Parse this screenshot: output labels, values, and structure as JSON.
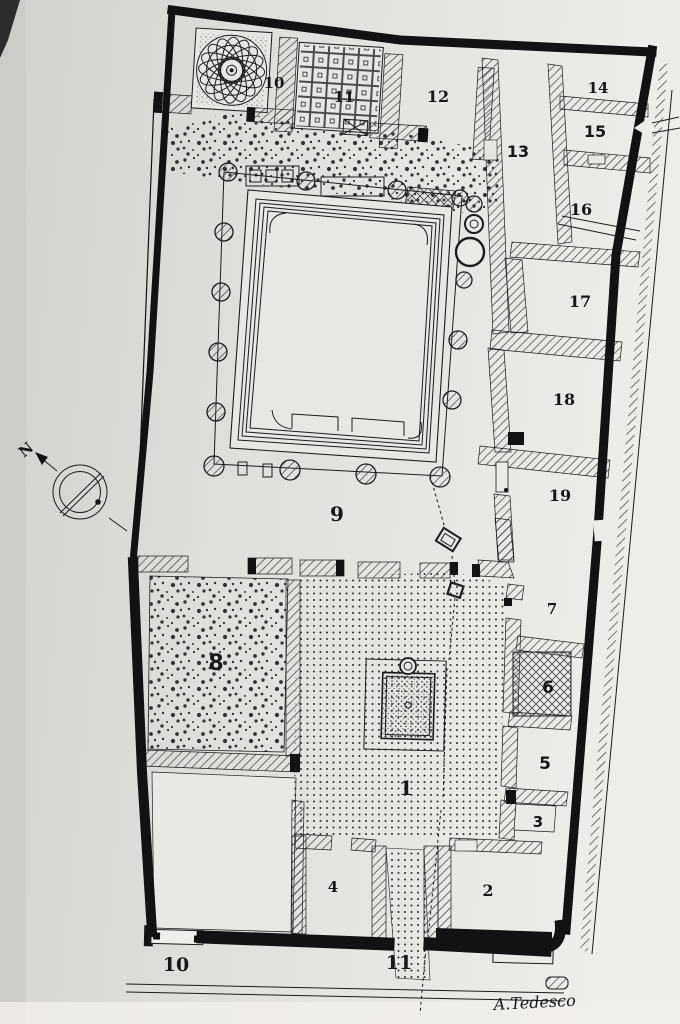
{
  "plan": {
    "rooms": {
      "r1": "1",
      "r2": "2",
      "r3": "3",
      "r4": "4",
      "r5": "5",
      "r6": "6",
      "r7": "7",
      "r8": "8",
      "r9": "9",
      "r10_top": "10",
      "r11_top": "11",
      "r12": "12",
      "r13": "13",
      "r14": "14",
      "r15": "15",
      "r16": "16",
      "r17": "17",
      "r18": "18",
      "r19": "19",
      "r10_entrance": "10",
      "r11_entrance": "11"
    },
    "compass_north": "N",
    "signature": "A.Tedesco",
    "colors": {
      "paper": "#dcdad6",
      "paper_light": "#eeece8",
      "ink": "#1c1c1c",
      "wall_black": "#121212"
    }
  }
}
